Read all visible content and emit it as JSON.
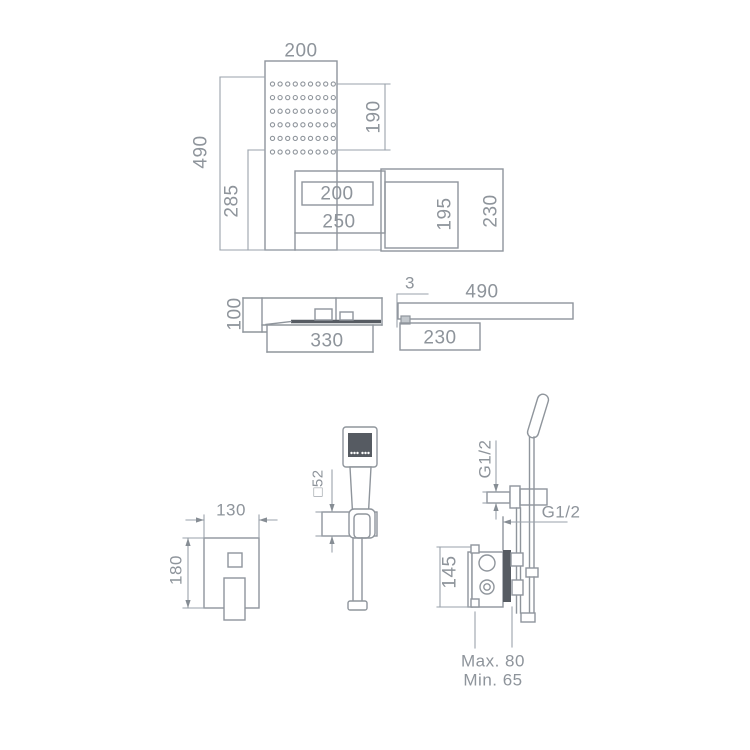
{
  "page": {
    "background": "#ffffff"
  },
  "colors": {
    "line": "#8f959c",
    "dim_line": "#9aa2ab",
    "text": "#8e949b",
    "text_accent": "#a9bdcf",
    "dark_fill": "#565b62"
  },
  "figures": {
    "front_view": {
      "panel_width": "200",
      "overall_height": "490",
      "lower_height": "285",
      "spray_field_height": "190",
      "opening_width": "200",
      "spout_width": "250",
      "inner_box_height": "195",
      "outer_box_height": "230"
    },
    "plan_view": {
      "depth": "100",
      "length": "330"
    },
    "side_view": {
      "edge_thickness": "3",
      "length": "490",
      "lower_depth": "230"
    },
    "mixer_trim": {
      "width": "130",
      "height": "180"
    },
    "hand_shower": {
      "holder_size": "□52"
    },
    "valve": {
      "top_thread": "G1/2",
      "side_thread": "G1/2",
      "body_height": "145",
      "depth_max": "Max. 80",
      "depth_min": "Min. 65"
    }
  }
}
